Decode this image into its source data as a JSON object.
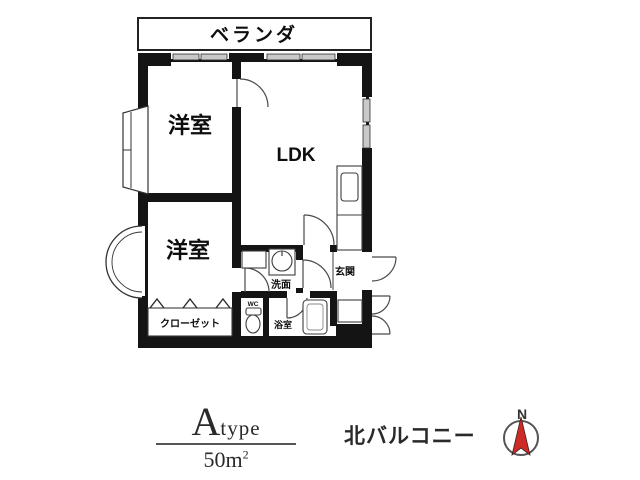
{
  "plan": {
    "veranda_label": "ベランダ",
    "bedroom1_label": "洋室",
    "bedroom2_label": "洋室",
    "ldk_label": "LDK",
    "closet_label": "クローゼット",
    "washroom_label": "洗面",
    "wc_label": "WC",
    "bath_label": "浴室",
    "entrance_label": "玄関"
  },
  "caption": {
    "type_letter": "A",
    "type_word": "type",
    "area_value": "50",
    "area_unit": "m",
    "area_sup": "2",
    "balcony_note": "北バルコニー",
    "compass_n": "N"
  },
  "colors": {
    "wall": "#141414",
    "window_fill": "#c9c9c9",
    "compass_needle": "#cf2b26",
    "background": "#ffffff"
  }
}
